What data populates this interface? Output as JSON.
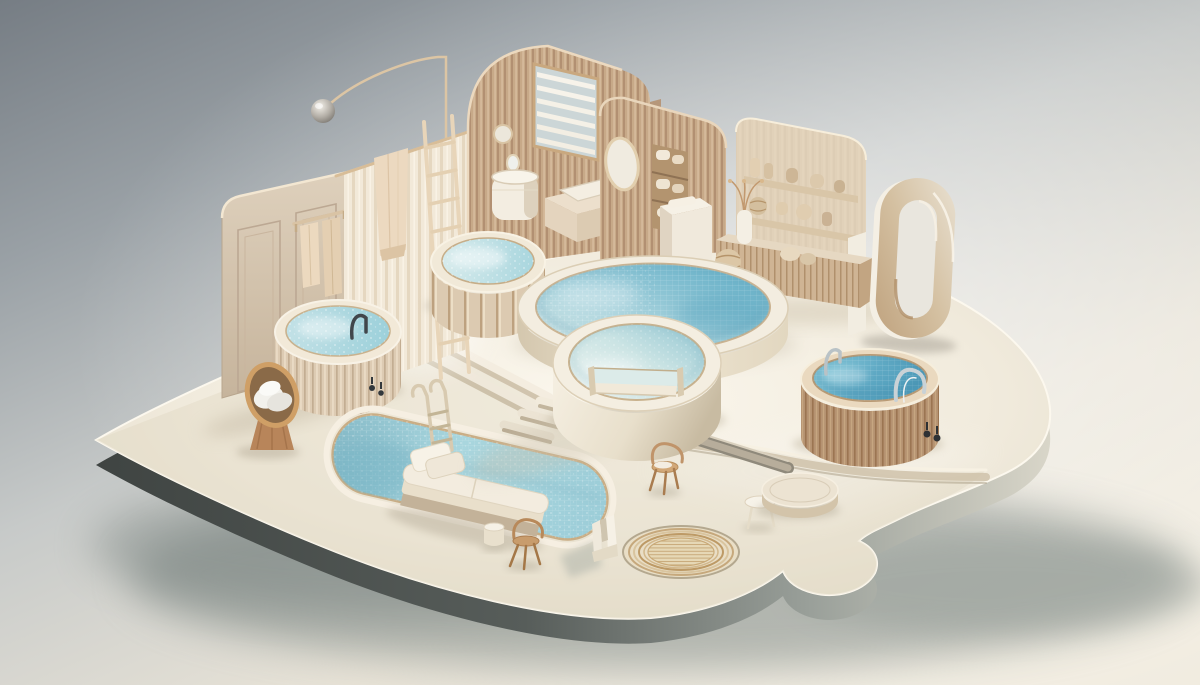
{
  "meta": {
    "title": "Miniature isometric spa diorama",
    "description": "3D rendered miniature wellness spa scene on a floating rounded platform: a large round pool with an attached plunge tub, four wooden hot tubs, a sunken lap pool with lounger and ladder, bathroom vignettes with sink, bench, shelves and vases, a shower curtain, ladder, arc lamp, an oval ring sculpture, rug and small furniture, lit softly from the upper right on a gray-to-cream gradient background."
  },
  "palette": {
    "background_top": "#7e858b",
    "background_bottom": "#f1ece0",
    "platform_top": "#f3eee3",
    "platform_side_dark": "#3f4442",
    "platform_side_light": "#d9d6c9",
    "wood_light": "#dccab2",
    "wood_mid": "#c7a988",
    "wood_tan": "#c29f7d",
    "towel_cream": "#ecd9c0",
    "water_pale": "#d8eae9",
    "water_deep": "#5cacc6",
    "water_milky": "#edf4f1",
    "chrome": "#c9d2d6",
    "ring_face": "#d0bb9c",
    "shadow": "#76817e",
    "rug_gold": "#bd9a66"
  },
  "objects": [
    {
      "id": "platform",
      "label": "rounded floating platform"
    },
    {
      "id": "upper-deck",
      "label": "raised pool deck"
    },
    {
      "id": "lower-apron",
      "label": "front lounge apron"
    },
    {
      "id": "main-pool",
      "label": "large round pool"
    },
    {
      "id": "plunge-tub",
      "label": "attached plunge tub with spillway notch"
    },
    {
      "id": "terrace-hot-tub",
      "label": "plank hot tub on terrace"
    },
    {
      "id": "left-hot-tub",
      "label": "slatted hot tub with dark faucet"
    },
    {
      "id": "right-hot-tub",
      "label": "tan slatted hot tub with chrome rail"
    },
    {
      "id": "lap-pool",
      "label": "sunken lap pool"
    },
    {
      "id": "pool-ladder",
      "label": "lap pool ladder"
    },
    {
      "id": "lounger",
      "label": "poolside daybed with pillows"
    },
    {
      "id": "egg-chair",
      "label": "egg chair with rolled towels"
    },
    {
      "id": "rug",
      "label": "round concentric-ring rug"
    },
    {
      "id": "ottoman-disc",
      "label": "round ottoman disc"
    },
    {
      "id": "side-table",
      "label": "small white side table"
    },
    {
      "id": "stool",
      "label": "white stool"
    },
    {
      "id": "front-chair",
      "label": "small wooden chair (front)"
    },
    {
      "id": "center-chair",
      "label": "small wooden chair (center)"
    },
    {
      "id": "door-wall",
      "label": "paneled door wall"
    },
    {
      "id": "towel-rail",
      "label": "towel rail with two towels"
    },
    {
      "id": "shower-curtain",
      "label": "pleated shower curtain"
    },
    {
      "id": "hanging-towel",
      "label": "towel over curtain rod"
    },
    {
      "id": "wall-ladder",
      "label": "leaning wooden ladder"
    },
    {
      "id": "arc-lamp",
      "label": "arc floor lamp"
    },
    {
      "id": "arch-wall",
      "label": "arched slatted wall with window"
    },
    {
      "id": "window-blinds",
      "label": "window with white blinds"
    },
    {
      "id": "round-mirror",
      "label": "small round wall mirror"
    },
    {
      "id": "pedestal-sink",
      "label": "pedestal sink"
    },
    {
      "id": "massage-bench",
      "label": "bench with cushion"
    },
    {
      "id": "mirror-wall",
      "label": "slatted wall with oval mirror and towel niche"
    },
    {
      "id": "white-cabinet",
      "label": "small white cabinet"
    },
    {
      "id": "shelf-wall",
      "label": "display wall with shelves of vases"
    },
    {
      "id": "credenza",
      "label": "slatted credenza with vases"
    },
    {
      "id": "branch-vase",
      "label": "vase with dried branches"
    },
    {
      "id": "ring-sculpture",
      "label": "standing oval ring sculpture"
    },
    {
      "id": "steps",
      "label": "deck steps"
    },
    {
      "id": "trench",
      "label": "recessed floor channel"
    },
    {
      "id": "notch-object",
      "label": "small white notched sculpture"
    }
  ],
  "counts": {
    "water_bodies": 6,
    "walls": 4,
    "chairs": 3
  }
}
